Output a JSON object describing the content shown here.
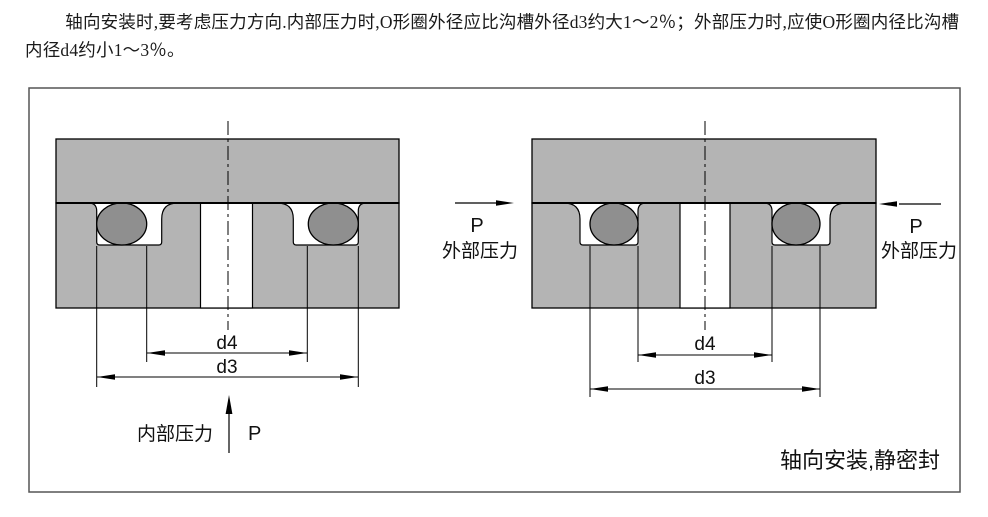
{
  "paragraph": "轴向安装时,要考虑压力方向.内部压力时,O形圈外径应比沟槽外径d3约大1～2％；外部压力时,应使O形圈内径比沟槽内径d4约小1～3％。",
  "caption": "轴向安装,静密封",
  "left_diagram": {
    "dim_inner": "d4",
    "dim_outer": "d3",
    "pressure_label": "内部压力",
    "pressure_symbol": "P"
  },
  "right_diagram": {
    "dim_inner": "d4",
    "dim_outer": "d3",
    "pressure_left": {
      "symbol": "P",
      "label": "外部压力"
    },
    "pressure_right": {
      "symbol": "P",
      "label": "外部压力"
    }
  },
  "colors": {
    "block_fill": "#b4b4b4",
    "oring_fill": "#8f8f8f",
    "line": "#000000",
    "frame": "#555555",
    "groove_fill": "#ffffff"
  }
}
